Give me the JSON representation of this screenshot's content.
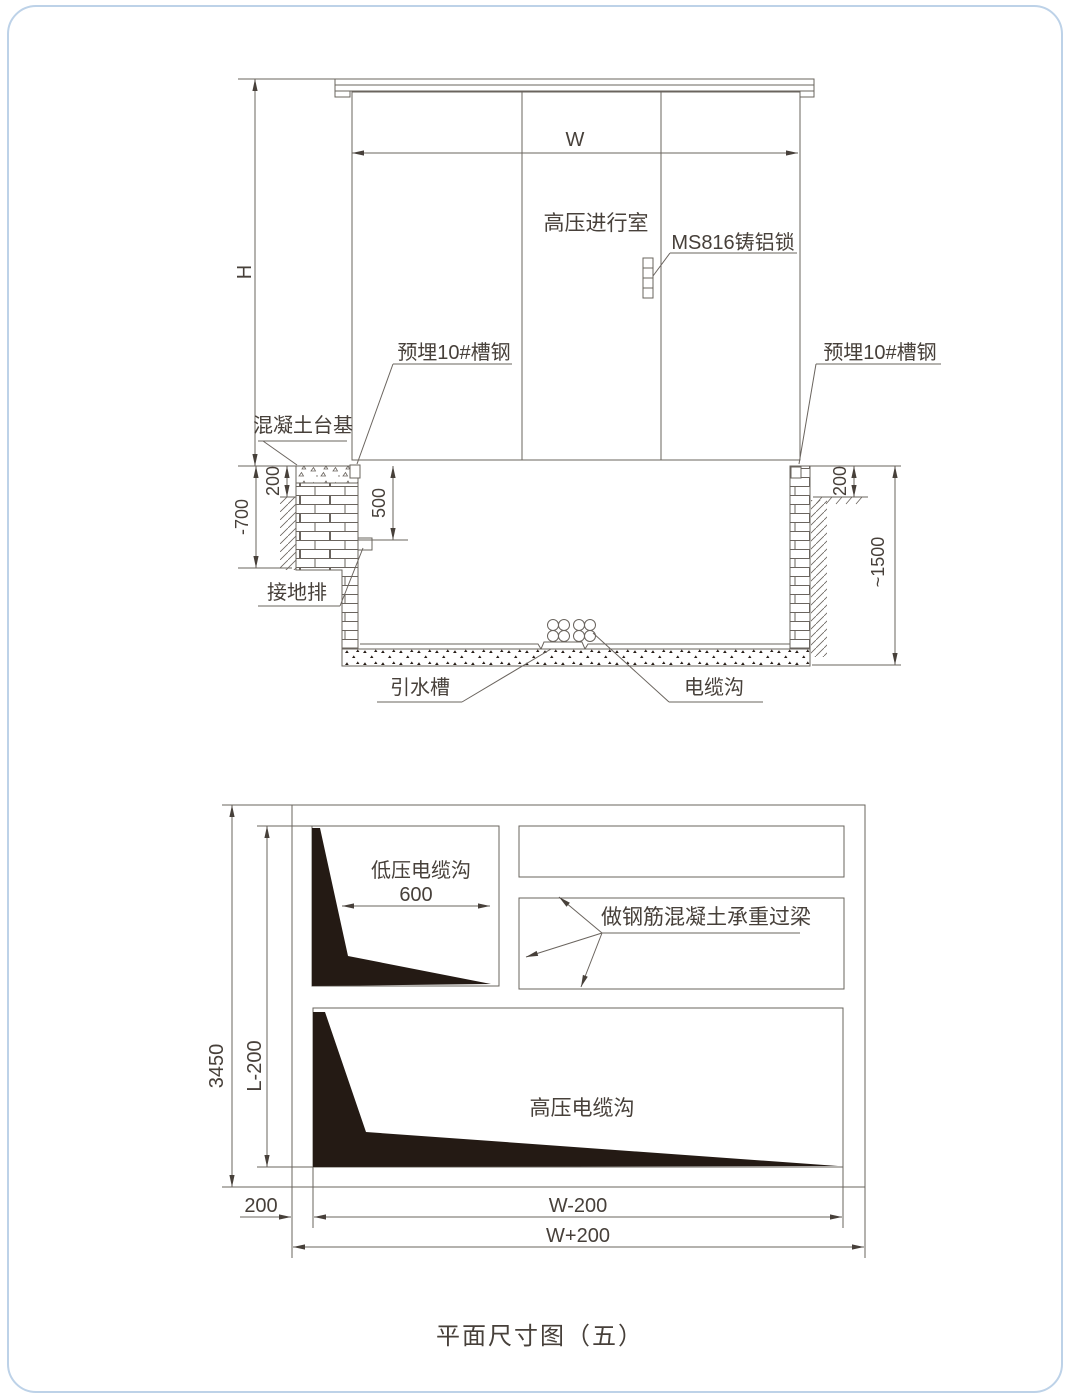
{
  "colors": {
    "border": "#bdd2e8",
    "ink": "#5d5650",
    "solid_fill": "#241a14"
  },
  "caption": "平面尺寸图（五）",
  "elevation": {
    "labels": {
      "room": "高压进行室",
      "lock": "MS816铸铝锁",
      "embedded_channel_left": "预埋10#槽钢",
      "embedded_channel_right": "预埋10#槽钢",
      "concrete_base": "混凝土台基",
      "grounding_bar": "接地排",
      "drain_channel": "引水槽",
      "cable_trench": "电缆沟"
    },
    "dims": {
      "width": "W",
      "height": "H",
      "pad_left": "200",
      "pad_right": "200",
      "pit_upper": "500",
      "frost_depth": "-700",
      "pit_total": "~1500"
    }
  },
  "plan": {
    "labels": {
      "lv_trench": "低压电缆沟",
      "beam_note": "做钢筋混凝土承重过梁",
      "hv_trench": "高压电缆沟"
    },
    "dims": {
      "lv_width": "600",
      "height_total": "3450",
      "height_inner": "L-200",
      "margin": "200",
      "inner_width": "W-200",
      "outer_width": "W+200"
    }
  }
}
